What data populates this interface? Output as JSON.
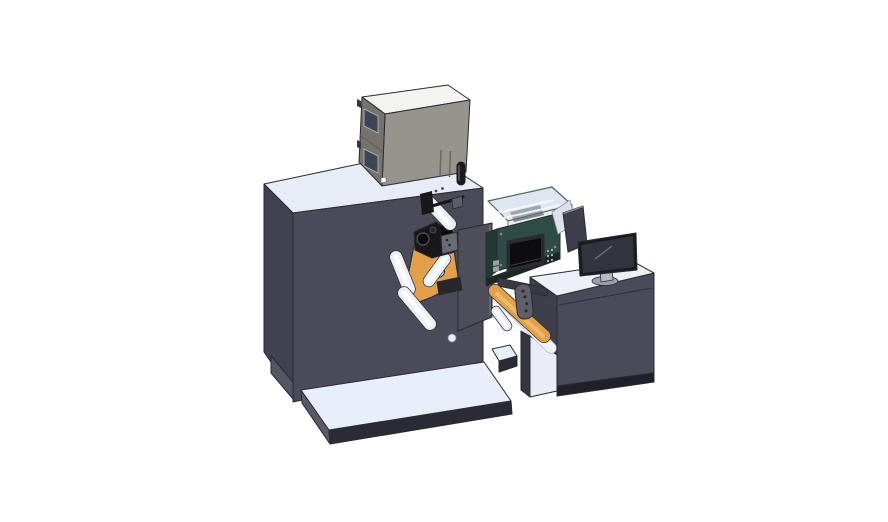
{
  "scene": {
    "title": "3D CAD render of an industrial label printing and rewinding machine: dark cabinet with electrical box on top, web rollers with orange guide plates, teal printer unit with clear cover and control screen, discharge chute, and an operator desk with a monitor on white base platforms",
    "background": "#ffffff",
    "canvas": {
      "width": 888,
      "height": 522
    }
  },
  "palette": {
    "bg": "#ffffff",
    "outline": "#2a2a32",
    "machineTop": "#e8ecf7",
    "machineFront": "#4a4a58",
    "machineLeft": "#414150",
    "machineFoot": "#565663",
    "faceCircle": "#e7ebf5",
    "platformTop": "#e9eefb",
    "platformFront": "#2b2b35",
    "platformSide": "#5a5a66",
    "cabinetTop": "#f3f3ef",
    "cabinetFront": "#96948c",
    "cabinetLeft": "#75736c",
    "cabinetSeam": "#605e58",
    "cabinetWindow": "#3d4454",
    "windowFrame": "#b9bcc4",
    "cabinetSlot": "#6b6a62",
    "labelWhite": "#ffffff",
    "knobDark": "#1b1b1f",
    "knobHi": "#4e4e56",
    "orange": "#e2a04b",
    "orangeHi": "#f0b868",
    "rollerEdge": "#2c2c34",
    "rollerFill": "#edeff6",
    "rollerHi": "#fdfdff",
    "mechBlack": "#17171c",
    "mechDark": "#0b0b0e",
    "mechRing": "#4a4a52",
    "mechGray": "#6a6a75",
    "mechBlock": "#5d5d68",
    "plateGray": "#4e4e5b",
    "plateEdge": "#6e6e7a",
    "tealFront": "#2f4c44",
    "tealSide": "#223a33",
    "tealDark": "#182822",
    "tealRim": "#51665f",
    "glass": "#d4dcea",
    "strut": "#f6f8fc",
    "magenta": "#c45aa5",
    "screenBezel": "#2b2b31",
    "screenFill": "#0d0d11",
    "screenLine": "#3a3a44",
    "buttonDot": "#b4b8be",
    "screwDot": "#7e8d86",
    "connector": "#9aa0a8",
    "barGray": "#3a3a45",
    "sheetWhite": "#eff2f8",
    "sheetEdge": "#b9bdc9",
    "bracketGray": "#5f5f6b",
    "holeDark": "#26262c",
    "deskFront": "#4a4a58",
    "deskSide": "#3f3f4c",
    "deskLeg": "#35353f",
    "deskBand": "#20202a",
    "deskTop": "#edf0f9",
    "insetWhite": "#e9edf7",
    "wedgeLight": "#dde1ec",
    "panelDark": "#3f3f4c",
    "panelEdge": "#8f8f9c",
    "monitorBezel": "#1a1a1f",
    "monitorScreen": "#34343f",
    "monitorLine": "#70707e",
    "standNeck": "#b5bac4",
    "standBase": "#99a0ab"
  },
  "parts": [
    {
      "id": "main-machine-cabinet",
      "desc": "large dark machine housing with light top"
    },
    {
      "id": "electrical-control-box",
      "desc": "gray electrical box sitting on machine top"
    },
    {
      "id": "cabinet-windows",
      "desc": "two dark inspection windows on box left face"
    },
    {
      "id": "base-platform-left",
      "desc": "white floor pedestal under machine"
    },
    {
      "id": "machine-foot-pedestal",
      "desc": "small white foot block at machine right"
    },
    {
      "id": "web-rollers",
      "desc": "white idler rollers guiding the label web"
    },
    {
      "id": "orange-guide-plates",
      "desc": "orange unwind guide plates"
    },
    {
      "id": "print-head-mechanism",
      "desc": "black print-head and clamp mechanism"
    },
    {
      "id": "front-support-plate",
      "desc": "gray vertical support plate"
    },
    {
      "id": "printer-enclosure",
      "desc": "teal printer unit with clear safety cover"
    },
    {
      "id": "control-display",
      "desc": "black control screen with side buttons"
    },
    {
      "id": "discharge-chute",
      "desc": "orange chute with white liner into desk shelf"
    },
    {
      "id": "sensor-bracket",
      "desc": "hanging bracket with holes"
    },
    {
      "id": "connecting-bar",
      "desc": "bar linking machine to desk"
    },
    {
      "id": "operator-desk",
      "desc": "dark desk cabinet with white top and open shelf"
    },
    {
      "id": "open-lid-panel",
      "desc": "dark open lid panel behind monitor"
    },
    {
      "id": "monitor",
      "desc": "desktop monitor on oval stand"
    }
  ]
}
